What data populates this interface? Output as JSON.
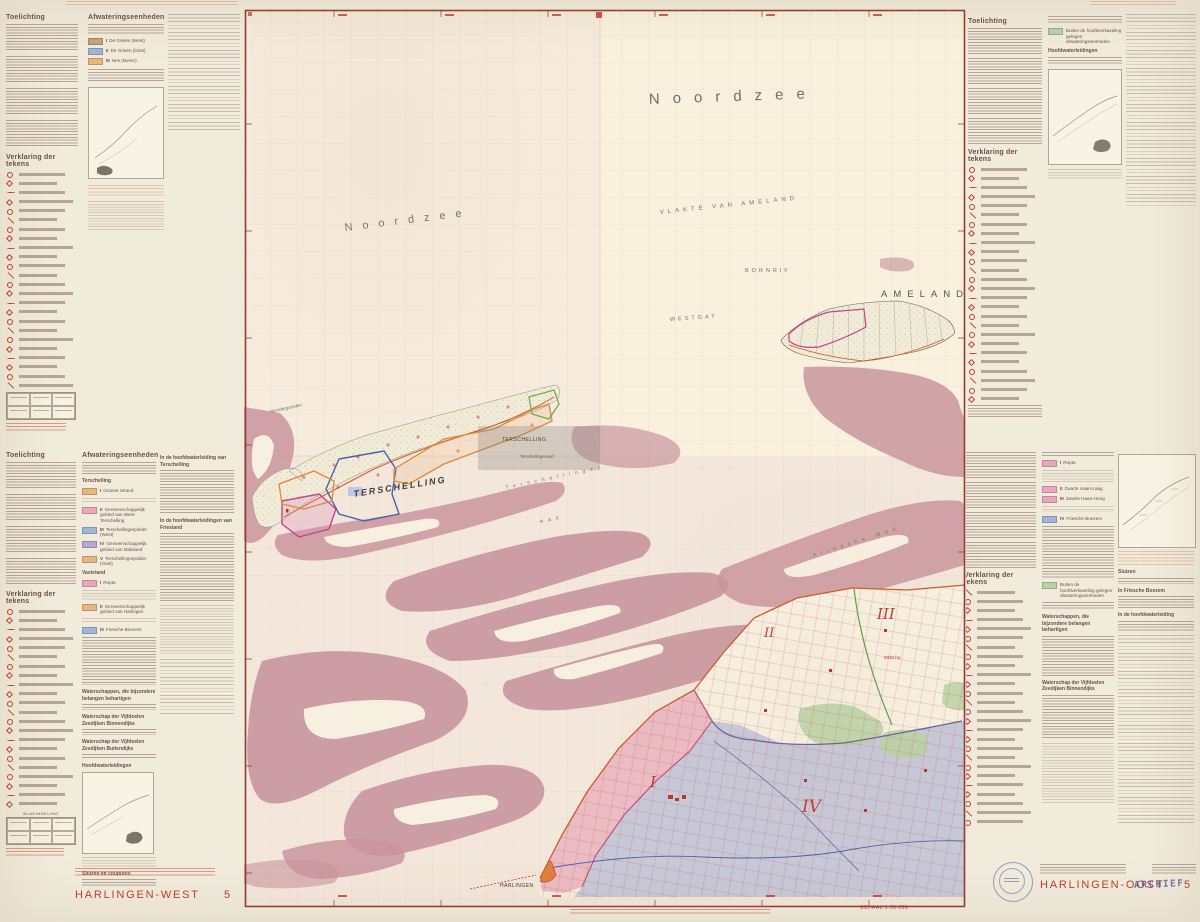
{
  "sheet": {
    "left_title": "HARLINGEN-WEST",
    "left_number": "5",
    "right_title": "HARLINGEN-OOST",
    "right_number": "5",
    "archief": "ARCHIEF",
    "scale": "SCHAAL 1:50.000"
  },
  "colors": {
    "paper": "#f1ebdc",
    "map_sea": "#f8f2e2",
    "wad_rose": "#c9959e",
    "overlay_pink": "#e59cb1",
    "overlay_blue": "#a9b1d5",
    "overlay_green": "#b9d3a3",
    "line_red": "#c0392f",
    "border_red": "#8f3c33",
    "dike_orange": "#cc5a2a",
    "unit_magenta": "#c0478c",
    "unit_blue": "#4e5fae",
    "unit_orange": "#e0883c",
    "unit_green": "#6fae48",
    "title_red": "#c13a2e",
    "archief_blue": "#5b5fae",
    "stamp_blue": "#4f63a8"
  },
  "headers": {
    "toelichting": "Toelichting",
    "verklaring": "Verklaring der tekens",
    "afwatering": "Afwateringseenheden",
    "terschelling": "Terschelling",
    "vasteland": "Vasteland",
    "hoofdwaterleidingen": "Hoofdwaterleidingen",
    "waterschappen": "Waterschappen, die bijzondere belangen behartigen",
    "ws_binnendijks": "Waterschap der Vijfdeelen Zeedijken Binnendijks",
    "ws_buitendijks": "Waterschap der Vijfdeelen Zeedijken Buitendijks",
    "sluizen": "Sluizen",
    "sluizen_coupures": "Sluizen en coupures",
    "in_friesche_boezem": "In Friesche Boezem",
    "in_hoofdwaterleiding": "In de hoofdwaterleiding",
    "hwl_terschelling": "In de hoofdwaterleiding van Terschelling",
    "hwl_friesland": "In de hoofdwaterleidingen van Friesland",
    "bladindeling": "BLADINDELING",
    "green_note": "Buiten de hoofdverkaveling gelegen afwateringseenheden"
  },
  "units": {
    "ameland": [
      {
        "numeral": "I",
        "name": "De Grieën (West)",
        "color": "#c8a17e"
      },
      {
        "numeral": "II",
        "name": "De Grieën (Oost)",
        "color": "#9fb6d8"
      },
      {
        "numeral": "III",
        "name": "Nes (Buren)",
        "color": "#e9b57e"
      }
    ],
    "terschelling": [
      {
        "numeral": "I",
        "name": "Groene Strand",
        "color": "#e9b57e"
      },
      {
        "numeral": "II",
        "name": "Gemeenschappelijk gebied van West-Terschelling",
        "color": "#eba6bd"
      },
      {
        "numeral": "III",
        "name": "Terschellingerpolder (West)",
        "color": "#9fb6d8"
      },
      {
        "numeral": "IV",
        "name": "Gemeenschappelijk gebied van Midsland",
        "color": "#b7a8d2"
      },
      {
        "numeral": "V",
        "name": "Terschellingerpolder (Oost)",
        "color": "#e9b57e"
      }
    ],
    "vasteland_west": [
      {
        "numeral": "I",
        "name": "Ropta",
        "color": "#eba6bd"
      },
      {
        "numeral": "II",
        "name": "Gemeenschappelijk gebied van Harlingen",
        "color": "#e9b57e"
      },
      {
        "numeral": "III",
        "name": "Friesche Boezem",
        "color": "#9fb6d8"
      }
    ],
    "vasteland_oost": [
      {
        "numeral": "I",
        "name": "Ropta",
        "color": "#eba6bd"
      },
      {
        "numeral": "II",
        "name": "Zwarte Haan-Laag",
        "color": "#eba6bd"
      },
      {
        "numeral": "III",
        "name": "Zwarte Haan-Hoog",
        "color": "#eba6bd"
      },
      {
        "numeral": "IV",
        "name": "Friesche Boezem",
        "color": "#9fb6d8"
      }
    ]
  },
  "map": {
    "labels": {
      "noordzee_large": "Noordzee",
      "noordzee_small": "Noordzee",
      "vlakte_van_ameland": "VLAKTE VAN AMELAND",
      "bornrif": "BORNRIF",
      "westgat": "WESTGAT",
      "ameland": "AMELAND",
      "terschelling_island": "TERSCHELLING",
      "terschelling_village": "TERSCHELLING",
      "terschellingerwad": "Terschellingerwad",
      "terschellinger_wad_1": "Terschellinger",
      "terschellinger_wad_2": "wad",
      "friesche_wad": "Friesche Wad",
      "noordergronden": "Noordergronden",
      "harlingen": "HARLINGEN",
      "area_5830": "5830 ha",
      "roman_i": "I",
      "roman_ii": "II",
      "roman_iii": "III",
      "roman_iv": "IV"
    }
  }
}
